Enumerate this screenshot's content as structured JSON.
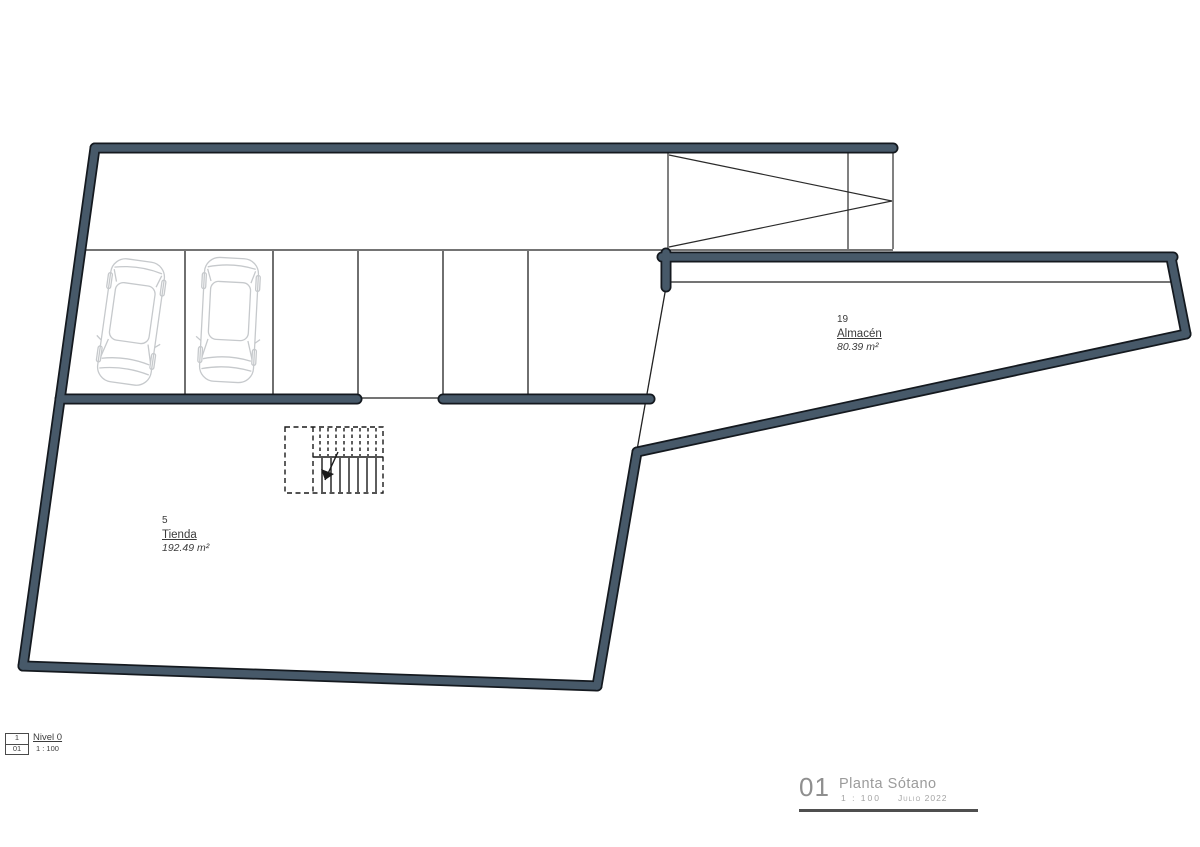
{
  "plan": {
    "wall_color": "#475969",
    "wall_outline_color": "#14191f",
    "thin_line_color": "#222222",
    "car_outline_color": "#c6c9cc",
    "rooms": [
      {
        "number": "5",
        "name": "Tienda",
        "area": "192.49 m²"
      },
      {
        "number": "19",
        "name": "Almacén",
        "area": "80.39 m²"
      }
    ]
  },
  "legend": {
    "ref_top": "1",
    "ref_bottom": "01",
    "level_name": "Nivel 0",
    "scale": "1 : 100"
  },
  "title_block": {
    "sheet_number": "01",
    "title": "Planta Sótano",
    "scale": "1 : 100",
    "date": "Julio 2022"
  }
}
